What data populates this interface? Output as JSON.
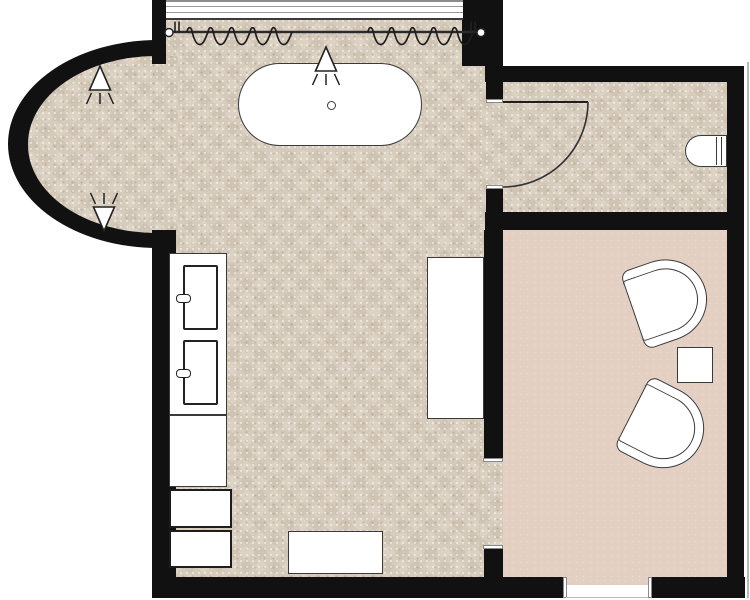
{
  "title": "bathroom-floor-plan",
  "colors": {
    "wall": "#111111",
    "floor-base": "#d8cdbd",
    "pink": "#e4d0c3",
    "outline": "#3a3a3a",
    "fill": "#ffffff",
    "line-gray": "#9a9a9a",
    "rod": "#2b2b2b"
  },
  "rooms": [
    {
      "name": "main-bathroom",
      "floor": "beige-mosaic-tile"
    },
    {
      "name": "curved-bay-alcove",
      "floor": "beige-mosaic-tile"
    },
    {
      "name": "wc-room",
      "floor": "beige-mosaic-tile"
    },
    {
      "name": "sitting-room",
      "floor": "pink-solid"
    }
  ],
  "fixtures": [
    {
      "name": "freestanding-bathtub",
      "room": "main-bathroom",
      "detail": "oval tub with center drain"
    },
    {
      "name": "window-with-curtains",
      "room": "main-bathroom",
      "detail": "curtain rod, two parted wavy panels, end finials"
    },
    {
      "name": "spotlight-symbol",
      "count": 3,
      "detail": "triangle with light rays; two in bay, one above tub"
    },
    {
      "name": "double-vanity",
      "room": "main-bathroom",
      "detail": "two rectangular sinks with faucets"
    },
    {
      "name": "base-drawers",
      "count": 2,
      "room": "main-bathroom"
    },
    {
      "name": "storage-cabinet",
      "room": "main-bathroom"
    },
    {
      "name": "bath-mat",
      "room": "main-bathroom"
    },
    {
      "name": "door-swing",
      "room": "wc-room",
      "detail": "90-degree arc opening into wc"
    },
    {
      "name": "toilet",
      "room": "wc-room"
    },
    {
      "name": "armchair",
      "count": 2,
      "room": "sitting-room",
      "detail": "rounded-back tub chairs"
    },
    {
      "name": "side-table",
      "room": "sitting-room"
    },
    {
      "name": "passage-opening",
      "detail": "between main bathroom and sitting room"
    },
    {
      "name": "entry-opening",
      "detail": "bottom wall of sitting room"
    }
  ]
}
